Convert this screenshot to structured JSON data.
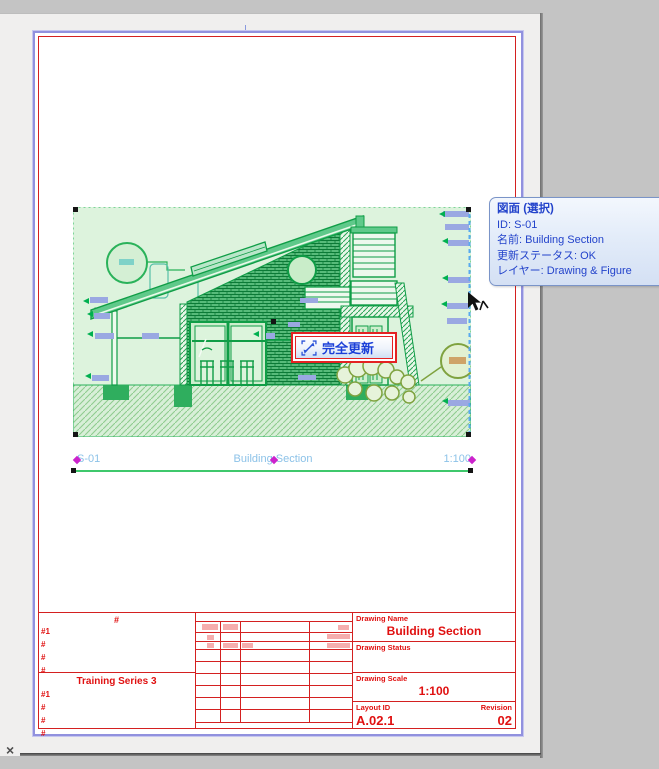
{
  "window": {
    "close": "×"
  },
  "tooltip": {
    "title": "図面 (選択)",
    "lines": [
      "ID: S-01",
      "名前: Building Section",
      "更新ステータス: OK",
      "レイヤー: Drawing & Figure"
    ]
  },
  "update_button": {
    "label": "完全更新"
  },
  "drawing_title": {
    "id": "S-01",
    "name": "Building Section",
    "scale": "1:100"
  },
  "title_block": {
    "left_top": {
      "header": "#",
      "rows": [
        "#1",
        "#",
        "#",
        "#"
      ]
    },
    "left_bottom": {
      "header": "Training Series 3",
      "rows": [
        "#1",
        "#",
        "#",
        "#"
      ]
    },
    "name": {
      "label": "Drawing Name",
      "value": "Building Section"
    },
    "status": {
      "label": "Drawing Status"
    },
    "scale": {
      "label": "Drawing Scale",
      "value": "1:100"
    },
    "layout_id": {
      "label": "Layout ID",
      "value": "A.02.1"
    },
    "revision": {
      "label": "Revision",
      "value": "02"
    }
  },
  "colors": {
    "accent_green": "#0f9d46",
    "selection_highlight": "#ddf3dd",
    "annotation_blue": "#9aa8e2",
    "hotspot_magenta": "#cc22cc",
    "titleblock_red": "#d42020",
    "tooltip_text": "#2343cb"
  }
}
